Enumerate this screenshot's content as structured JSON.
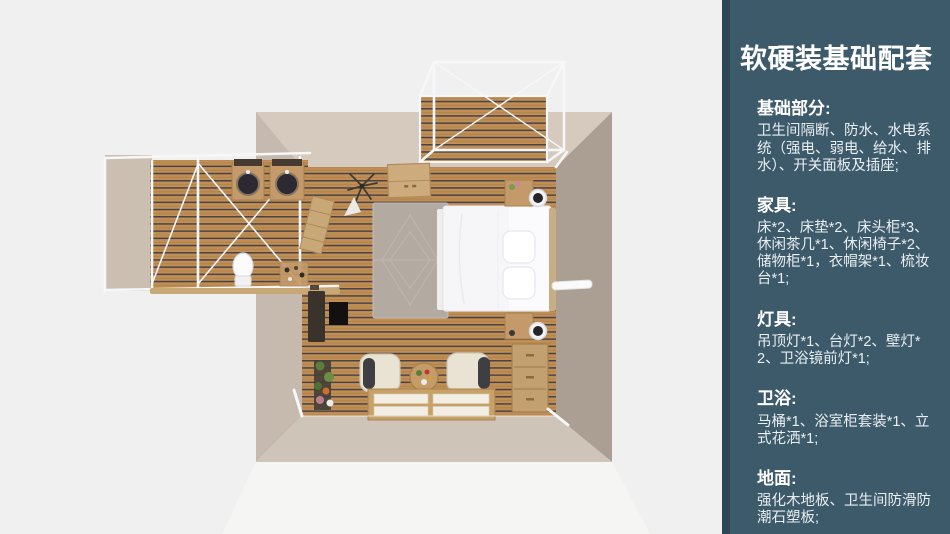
{
  "slide": {
    "background_color": "#f0f0f1"
  },
  "sidebar": {
    "background_color": "#3d5a6b",
    "edge_color": "#2e4755",
    "text_color": "#ffffff",
    "title": "软硬装基础配套",
    "sections": [
      {
        "heading": "基础部分:",
        "body": "卫生间隔断、防水、水电系统（强电、弱电、给水、排水）、开关面板及插座;"
      },
      {
        "heading": "家具:",
        "body": "床*2、床垫*2、床头柜*3、休闲茶几*1、休闲椅子*2、储物柜*1，衣帽架*1、梳妆台*1;"
      },
      {
        "heading": "灯具:",
        "body": "吊顶灯*1、台灯*2、壁灯*2、卫浴镜前灯*1;"
      },
      {
        "heading": "卫浴:",
        "body": "马桶*1、浴室柜套装*1、立式花洒*1;"
      },
      {
        "heading": "地面:",
        "body": "强化木地板、卫生间防滑防潮石塑板;"
      }
    ]
  },
  "floorplan": {
    "colors": {
      "wall": "#cfc3b7",
      "wall_shadow": "#ab9f94",
      "floor_plank": "#c18e54",
      "plank_gap": "#46434b",
      "frame_white": "#f6f7f8",
      "wood_furniture": "#c49a6a"
    },
    "icons": [
      "double-bed-icon",
      "pillow-icon",
      "rug-icon",
      "nightstand-icon",
      "table-lamp-icon",
      "wardrobe-icon",
      "coat-rack-icon",
      "desk-icon",
      "plant-stand-icon",
      "armchair-icon",
      "coffee-table-icon",
      "tatami-platform-icon",
      "drawer-chest-icon",
      "sink-basin-icon",
      "toilet-icon",
      "pergola-frame-icon",
      "deck-floor-icon"
    ]
  }
}
